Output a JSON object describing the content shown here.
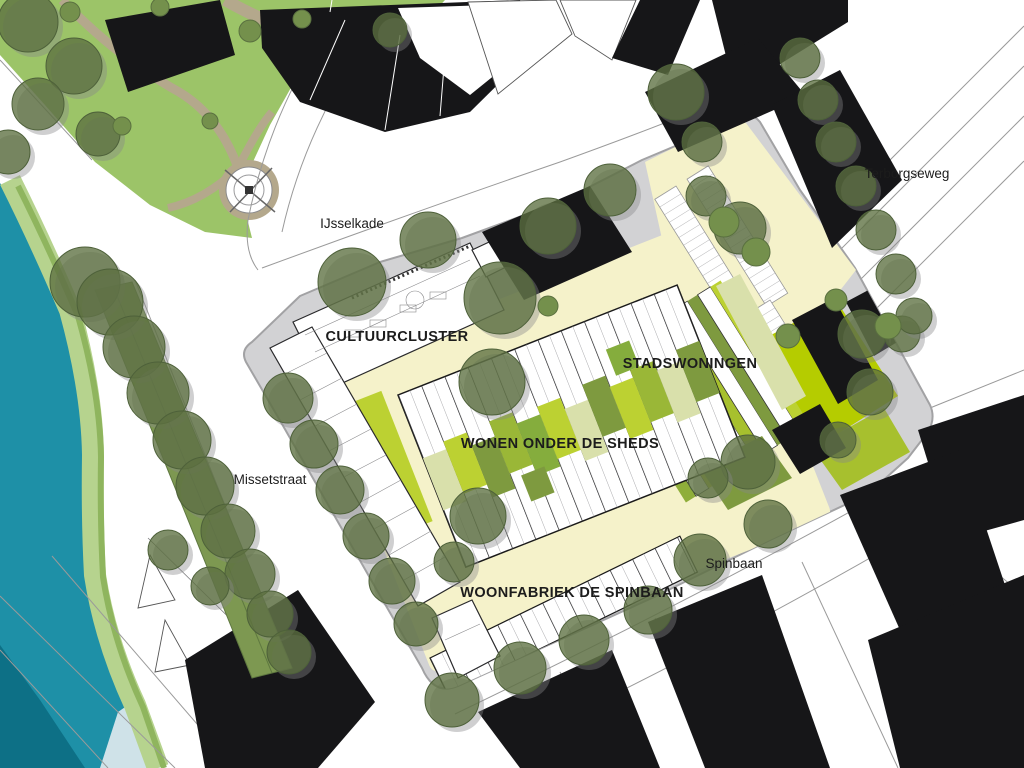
{
  "map": {
    "type": "architectural-site-plan",
    "streets": [
      {
        "id": "terborgseweg",
        "label": "Terborgseweg"
      },
      {
        "id": "ijsselkade",
        "label": "IJsselkade"
      },
      {
        "id": "missetstraat",
        "label": "Missetstraat"
      },
      {
        "id": "spinbaan",
        "label": "Spinbaan"
      }
    ],
    "districts": [
      {
        "id": "cultuurcluster",
        "label": "CULTUURCLUSTER"
      },
      {
        "id": "stadswoningen",
        "label": "STADSWONINGEN"
      },
      {
        "id": "wonen-onder-de-sheds",
        "label": "WONEN ONDER DE SHEDS"
      },
      {
        "id": "woonfabriek-de-spinbaan",
        "label": "WOONFABRIEK DE SPINBAAN"
      }
    ],
    "colors": {
      "water": "#1e90a7",
      "water_deep": "#0d7086",
      "water_pale": "#cfe2e8",
      "grass": "#9cc468",
      "bank_light": "#b6d38e",
      "bank_mid": "#8fb55e",
      "hedge": "#7d9851",
      "path_tan": "#b4a88c",
      "building_black": "#161618",
      "site_grey": "#d2d2d4",
      "courtyard_yellow": "#f5f2ca",
      "lawn_green": "#85ad3d",
      "lime_green": "#b5cc00",
      "lime_light": "#bcd132",
      "olive_green": "#7e9a3f",
      "mid_green": "#9ab737",
      "pale_green": "#d9e0ab",
      "tree_canopy": "#5c7040",
      "tree_solid": "#74904c"
    }
  }
}
